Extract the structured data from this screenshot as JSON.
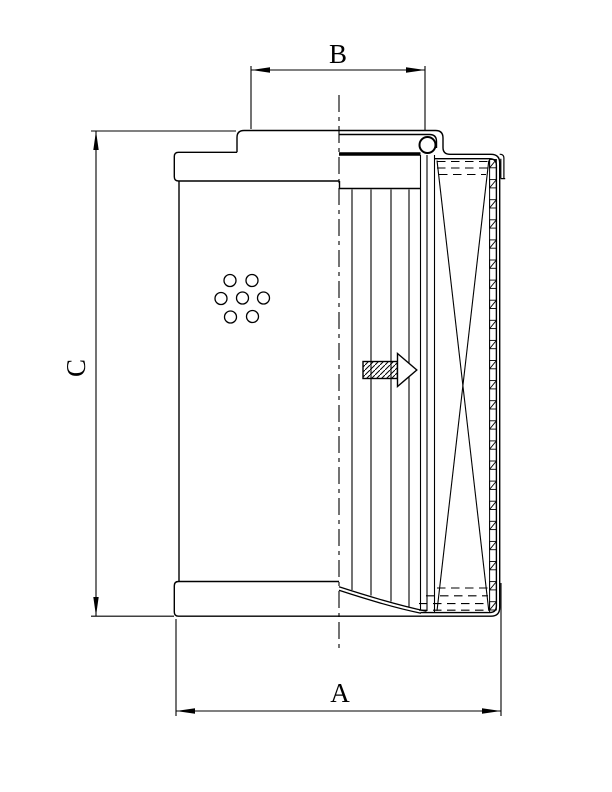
{
  "colors": {
    "line": "#000000",
    "background": "#ffffff"
  },
  "dimensions": {
    "top_width": {
      "label": "B"
    },
    "left_height": {
      "label": "C"
    },
    "bottom_width": {
      "label": "A"
    }
  },
  "icons": {
    "flow_direction": "hatched-block-arrow-right",
    "centerline": "dash-dot-centerline",
    "seal": "o-ring"
  }
}
